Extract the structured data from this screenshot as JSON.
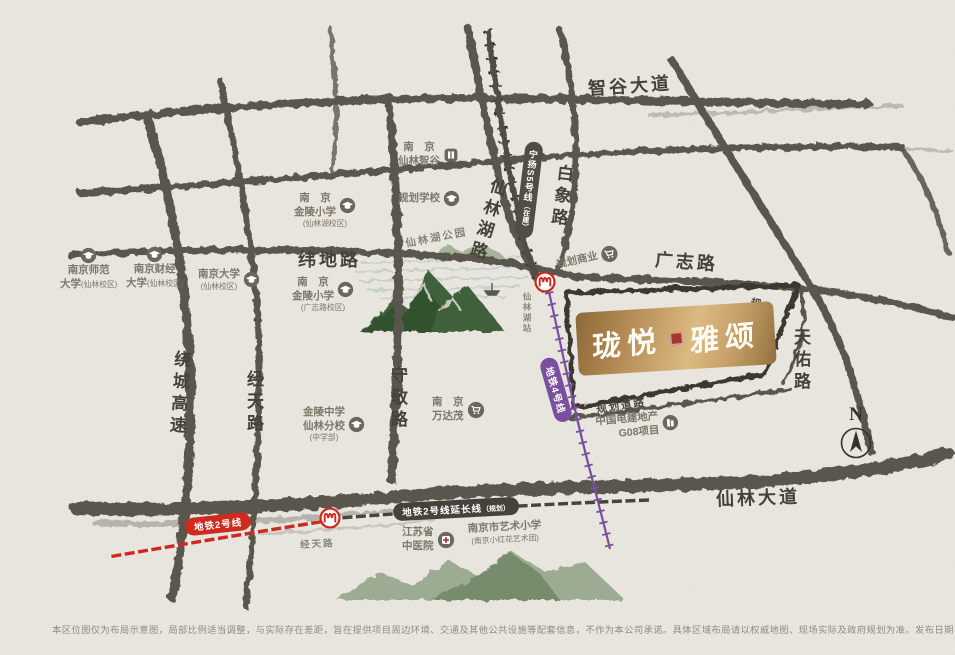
{
  "logo": {
    "name_left": "珑悦",
    "name_right": "雅颂"
  },
  "compass": {
    "label": "N"
  },
  "roads": {
    "zhigu": "智谷大道",
    "weidi": "纬地路",
    "guangzhi": "广志路",
    "xianlin_ave": "仙林大道",
    "raocheng": "绕城高速",
    "jingtian": "经天路",
    "shoujing": "守敬路",
    "xianlinhu": "仙林湖路",
    "baixiang": "白象路",
    "tianyou": "天佑路",
    "planned_e": "规划道路",
    "planned_s": "规划道路"
  },
  "metro": {
    "line2": {
      "label": "地铁2号线"
    },
    "line2_ext": {
      "label": "地铁2号线延长线",
      "suffix": "（规划）"
    },
    "line4": {
      "label": "地铁4号线"
    },
    "s5": {
      "label": "宁扬S5号线",
      "suffix": "（在建）"
    },
    "station_jingtian": "经天路",
    "station_xianlinhu": "仙林湖站"
  },
  "pois": [
    {
      "l1": "南京师范",
      "l2": "大学",
      "sub": "(仙林校区)"
    },
    {
      "l1": "南京财经",
      "l2": "大学",
      "sub": "(仙林校区)"
    },
    {
      "l1": "南京大学",
      "sub": "(仙林校区)"
    },
    {
      "l1": "南　京",
      "l2": "金陵小学",
      "sub": "(仙林湖校区)"
    },
    {
      "l1": "规划学校"
    },
    {
      "l1": "南　京",
      "l2": "仙林智谷"
    },
    {
      "l1": "仙林湖公园"
    },
    {
      "l1": "南　京",
      "l2": "金陵小学",
      "sub": "(广志路校区)"
    },
    {
      "l1": "金陵中学",
      "l2": "仙林分校",
      "sub": "(中学部)"
    },
    {
      "l1": "南　京",
      "l2": "万达茂"
    },
    {
      "l1": "规划商业"
    },
    {
      "l1": "中国电建地产",
      "l2": "G08项目"
    },
    {
      "l1": "江苏省",
      "l2": "中医院"
    },
    {
      "l1": "南京市艺术小学",
      "sub": "(南京小红花艺术团)"
    }
  ],
  "colors": {
    "road": "#5a574e",
    "metro2": "#cf2a20",
    "metro2_ext": "#46443e",
    "metro4": "#7a4fa0",
    "gold_light": "#dcba83",
    "gold_dark": "#8d6838",
    "seal": "#a8352a"
  },
  "disclaimer": "本区位图仅为布局示意图，局部比例适当调整，与实际存在差距，旨在提供项目周边环境、交通及其他公共设施等配套信息，不作为本公司承诺。具体区域布局请以权威地图、现场实际及政府规划为准。发布日期：2022年8月"
}
